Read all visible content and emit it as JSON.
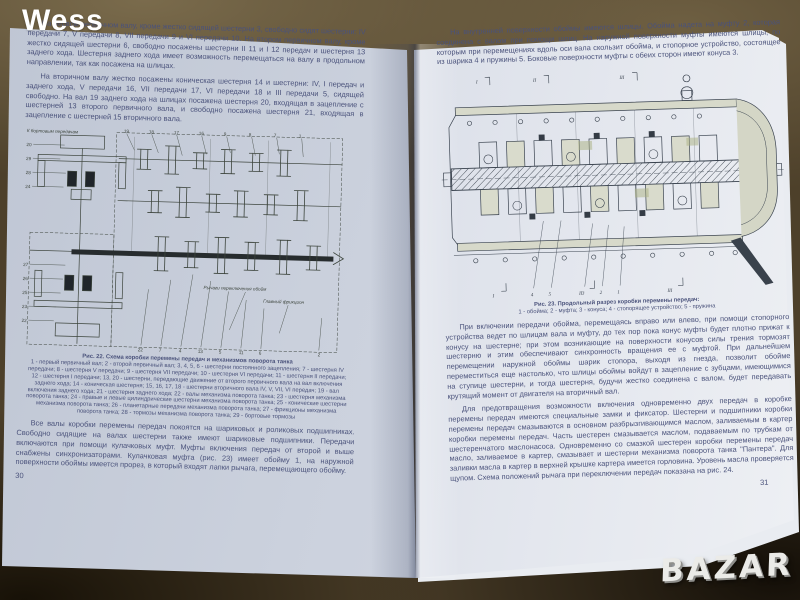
{
  "scene": {
    "watermark": "Wess",
    "logo": "BAZAR"
  },
  "left_page": {
    "page_number": "30",
    "para1": "На первом первичном валу, кроме жестко сидящей шестерни 3, свободно сидят шестерни: IV передачи 7, V передачи 8, VII передачи 9 и VI передачи 10. На втором первичном валу, кроме жестко сидящей шестерни 6, свободно посажены шестерни II 11 и I 12 передач и шестерня 13 заднего хода. Шестерня заднего хода имеет возможность перемещаться на валу в продольном направлении, так как посажена на шлицах.",
    "para2": "На вторичном валу жестко посажены коническая шестерня 14 и шестерни: IV, I передач и заднего хода, V передачи 16, VII передачи 17, VI передачи 18 и III передачи 5, сидящей свободно. На вал 19 заднего хода на шлицах посажена шестерня 20, входящая в зацепление с шестерней 13 второго первичного вала, и свободно посажена шестерня 21, входящая в зацепление с шестерней 15 вторичного вала.",
    "para3": "Все валы коробки перемены передач покоятся на шариковых и роликовых подшипниках. Свободно сидящие на валах шестерни также имеют шариковые подшипники. Передачи включаются при помощи кулачковых муфт. Муфты включения передач от второй и выше снабжены синхронизаторами. Кулачковая муфта (рис. 23) имеет обойму 1, на наружной поверхности обоймы имеется прорез, в который входят лапки рычага, перемещающего обойму.",
    "figure": {
      "caption_title": "Рис. 22. Схема коробки перемены передач и механизмов поворота танка",
      "caption_body": "1 - первый первичный вал; 2 - второй первичный вал; 3, 4, 5, 6 - шестерни постоянного зацепления; 7 - шестерня IV передачи; 8 - шестерня V передачи; 9 - шестерня VII передачи; 10 - шестерня VI передачи; 11 - шестерня II передачи; 12 - шестерня I передачи; 13, 20 - шестерни, передающие движение от второго первичного вала на вал включения заднего хода; 14 - коническая шестерня; 15, 16, 17, 18 - шестерни вторичного вала IV, V, VII, VI передач; 19 - вал включения заднего хода; 21 - шестерня заднего хода; 22 - валы механизма поворота танка; 23 - шестерня механизма поворота танка; 24 - правые и левые цилиндрические шестерни механизма поворота танка; 25 - конические шестерни механизма поворота танка; 26 - планетарные передачи механизма поворота танка; 27 - фрикционы механизма поворота танка; 28 - тормозы механизма поворота танка; 29 - бортовые тормозы",
      "label_top": "К бортовым передачам",
      "label_forks": "Рычаги переключения обойм",
      "label_friction": "Главный фрикцион",
      "callouts_left": [
        "20",
        "29",
        "28",
        "24",
        "27",
        "26",
        "25",
        "23",
        "22"
      ],
      "callouts_top": [
        "19",
        "18",
        "17",
        "16",
        "9",
        "8",
        "7",
        "1"
      ],
      "callouts_bottom": [
        "22",
        "7",
        "4",
        "13",
        "5",
        "11",
        "6",
        "2"
      ]
    }
  },
  "right_page": {
    "page_number": "31",
    "para1": "На внутренней поверхности обоймы имеются шлицы. Обойма надета на муфту 2, которая соединена с валом при помощи шлиц. На наружной поверхности муфты имеются шлицы, по которым при перемещениях вдоль оси вала скользит обойма, и стопорное устройство, состоящее из шарика 4 и пружины 5. Боковые поверхности муфты с обеих сторон имеют конуса 3.",
    "para2": "При включении передачи обойма, перемещаясь вправо или влево, при помощи стопорного устройства ведет по шлицам вала и муфту, до тех пор пока конус муфты будет плотно прижат к конусу на шестерне; при этом возникающие на поверхности конусов силы трения тормозят шестерню и этим обеспечивают синхронность вращения ее с муфтой. При дальнейшем перемещении наружной обоймы шарик стопора, выходя из гнезда, позволит обойме переместиться еще настолько, что шлицы обоймы войдут в зацепление с зубцами, имеющимися на ступице шестерни, и тогда шестерня, будучи жестко соединена с валом, будет передавать крутящий момент от двигателя на вторичный вал.",
    "para3": "Для предотвращения возможности включения одновременно двух передач в коробке перемены передач имеются специальные замки и фиксатор. Шестерни и подшипники коробки перемены передач смазываются в основном разбрызгивающимся маслом, заливаемым в картер коробки перемены передач. Часть шестерен смазывается маслом, подаваемым по трубкам от шестеренчатого маслонасоса. Одновременно со смазкой шестерен коробки перемены передач масло, заливаемое в картер, смазывает и шестерни механизма поворота танка \"Пантера\". Для заливки масла в картер в верхней крышке картера имеется горловина. Уровень масла проверяется щупом. Схема положений рычага при переключении передач показана на рис. 24.",
    "figure": {
      "caption_title": "Рис. 23. Продольный разрез коробки перемены передач:",
      "caption_body": "1 - обойма; 2 - муфта; 3 - конуса; 4 - стопорящее устройство; 5 - пружина",
      "sections_top": [
        "I",
        "II",
        "III"
      ],
      "sections_bottom": [
        "I",
        "II",
        "III"
      ],
      "callouts": [
        "4",
        "5",
        "3",
        "2",
        "1"
      ]
    }
  }
}
